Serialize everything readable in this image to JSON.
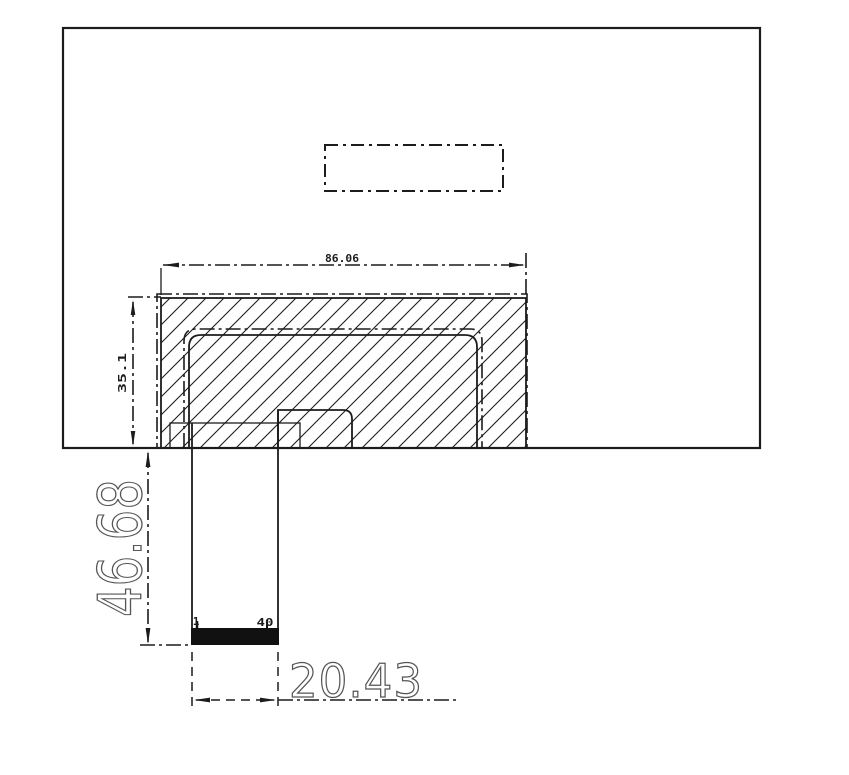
{
  "drawing": {
    "type": "engineering-dimension-drawing",
    "dimensions": {
      "block_width": "86.06",
      "block_height": "35.1",
      "tail_length": "46.68",
      "tail_width": "20.43"
    },
    "pins": {
      "first": "1",
      "last": "40"
    },
    "colors": {
      "background": "#ffffff",
      "line": "#1c1c1c",
      "dim_text_large": "#555555",
      "connector_fill": "#111111"
    }
  }
}
